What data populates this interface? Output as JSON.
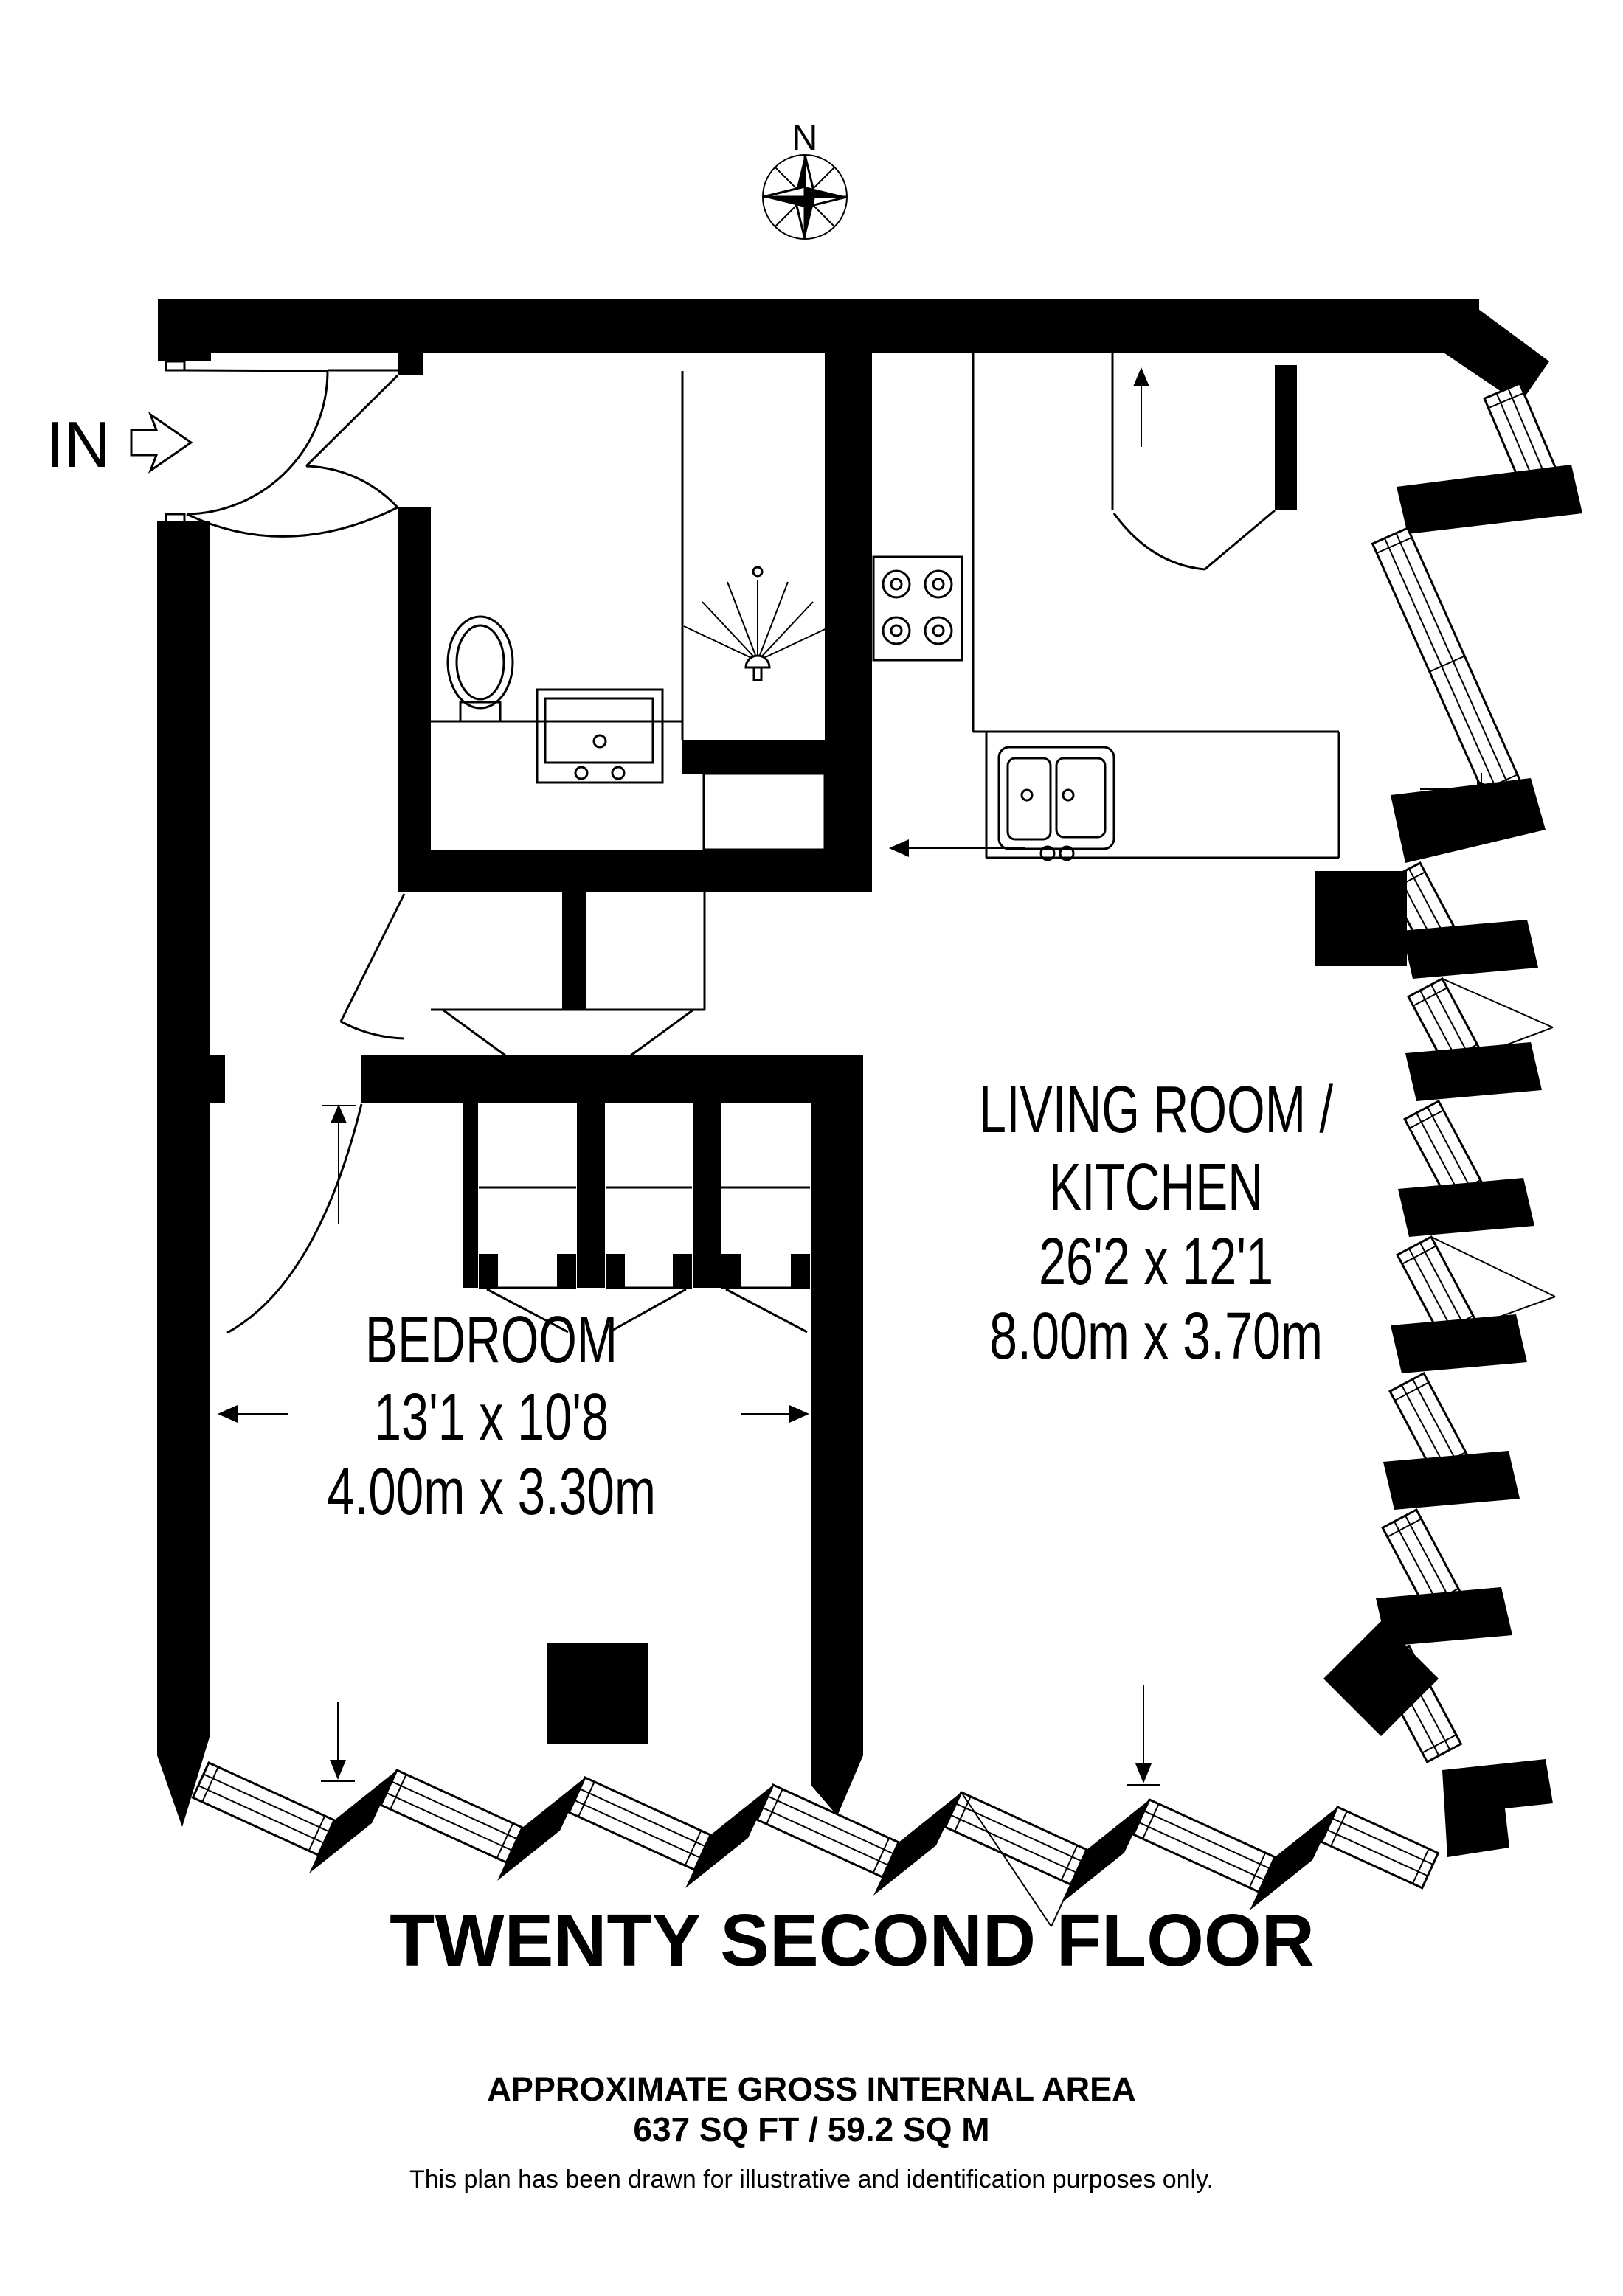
{
  "plan": {
    "compass_label": "N",
    "entrance_label": "IN",
    "rooms": [
      {
        "id": "living-room-kitchen",
        "name_line1": "LIVING ROOM /",
        "name_line2": "KITCHEN",
        "dims_imperial": "26'2 x 12'1",
        "dims_metric": "8.00m x 3.70m"
      },
      {
        "id": "bedroom",
        "name": "BEDROOM",
        "dims_imperial": "13'1 x 10'8",
        "dims_metric": "4.00m x 3.30m"
      }
    ],
    "icons": [
      "compass-rose-icon",
      "entrance-arrow-icon",
      "toilet-icon",
      "vanity-basin-icon",
      "shower-head-icon",
      "stove-icon",
      "double-sink-icon",
      "door-swing-arc",
      "window-strip",
      "structural-column",
      "dimension-arrow"
    ],
    "colors": {
      "wall": "#000000",
      "background": "#ffffff",
      "line": "#000000"
    }
  },
  "footer": {
    "floor_title": "TWENTY SECOND FLOOR",
    "area_heading": "APPROXIMATE GROSS INTERNAL AREA",
    "area_value": "637 SQ FT / 59.2 SQ M",
    "disclaimer": "This plan has been drawn for illustrative and identification purposes only."
  }
}
